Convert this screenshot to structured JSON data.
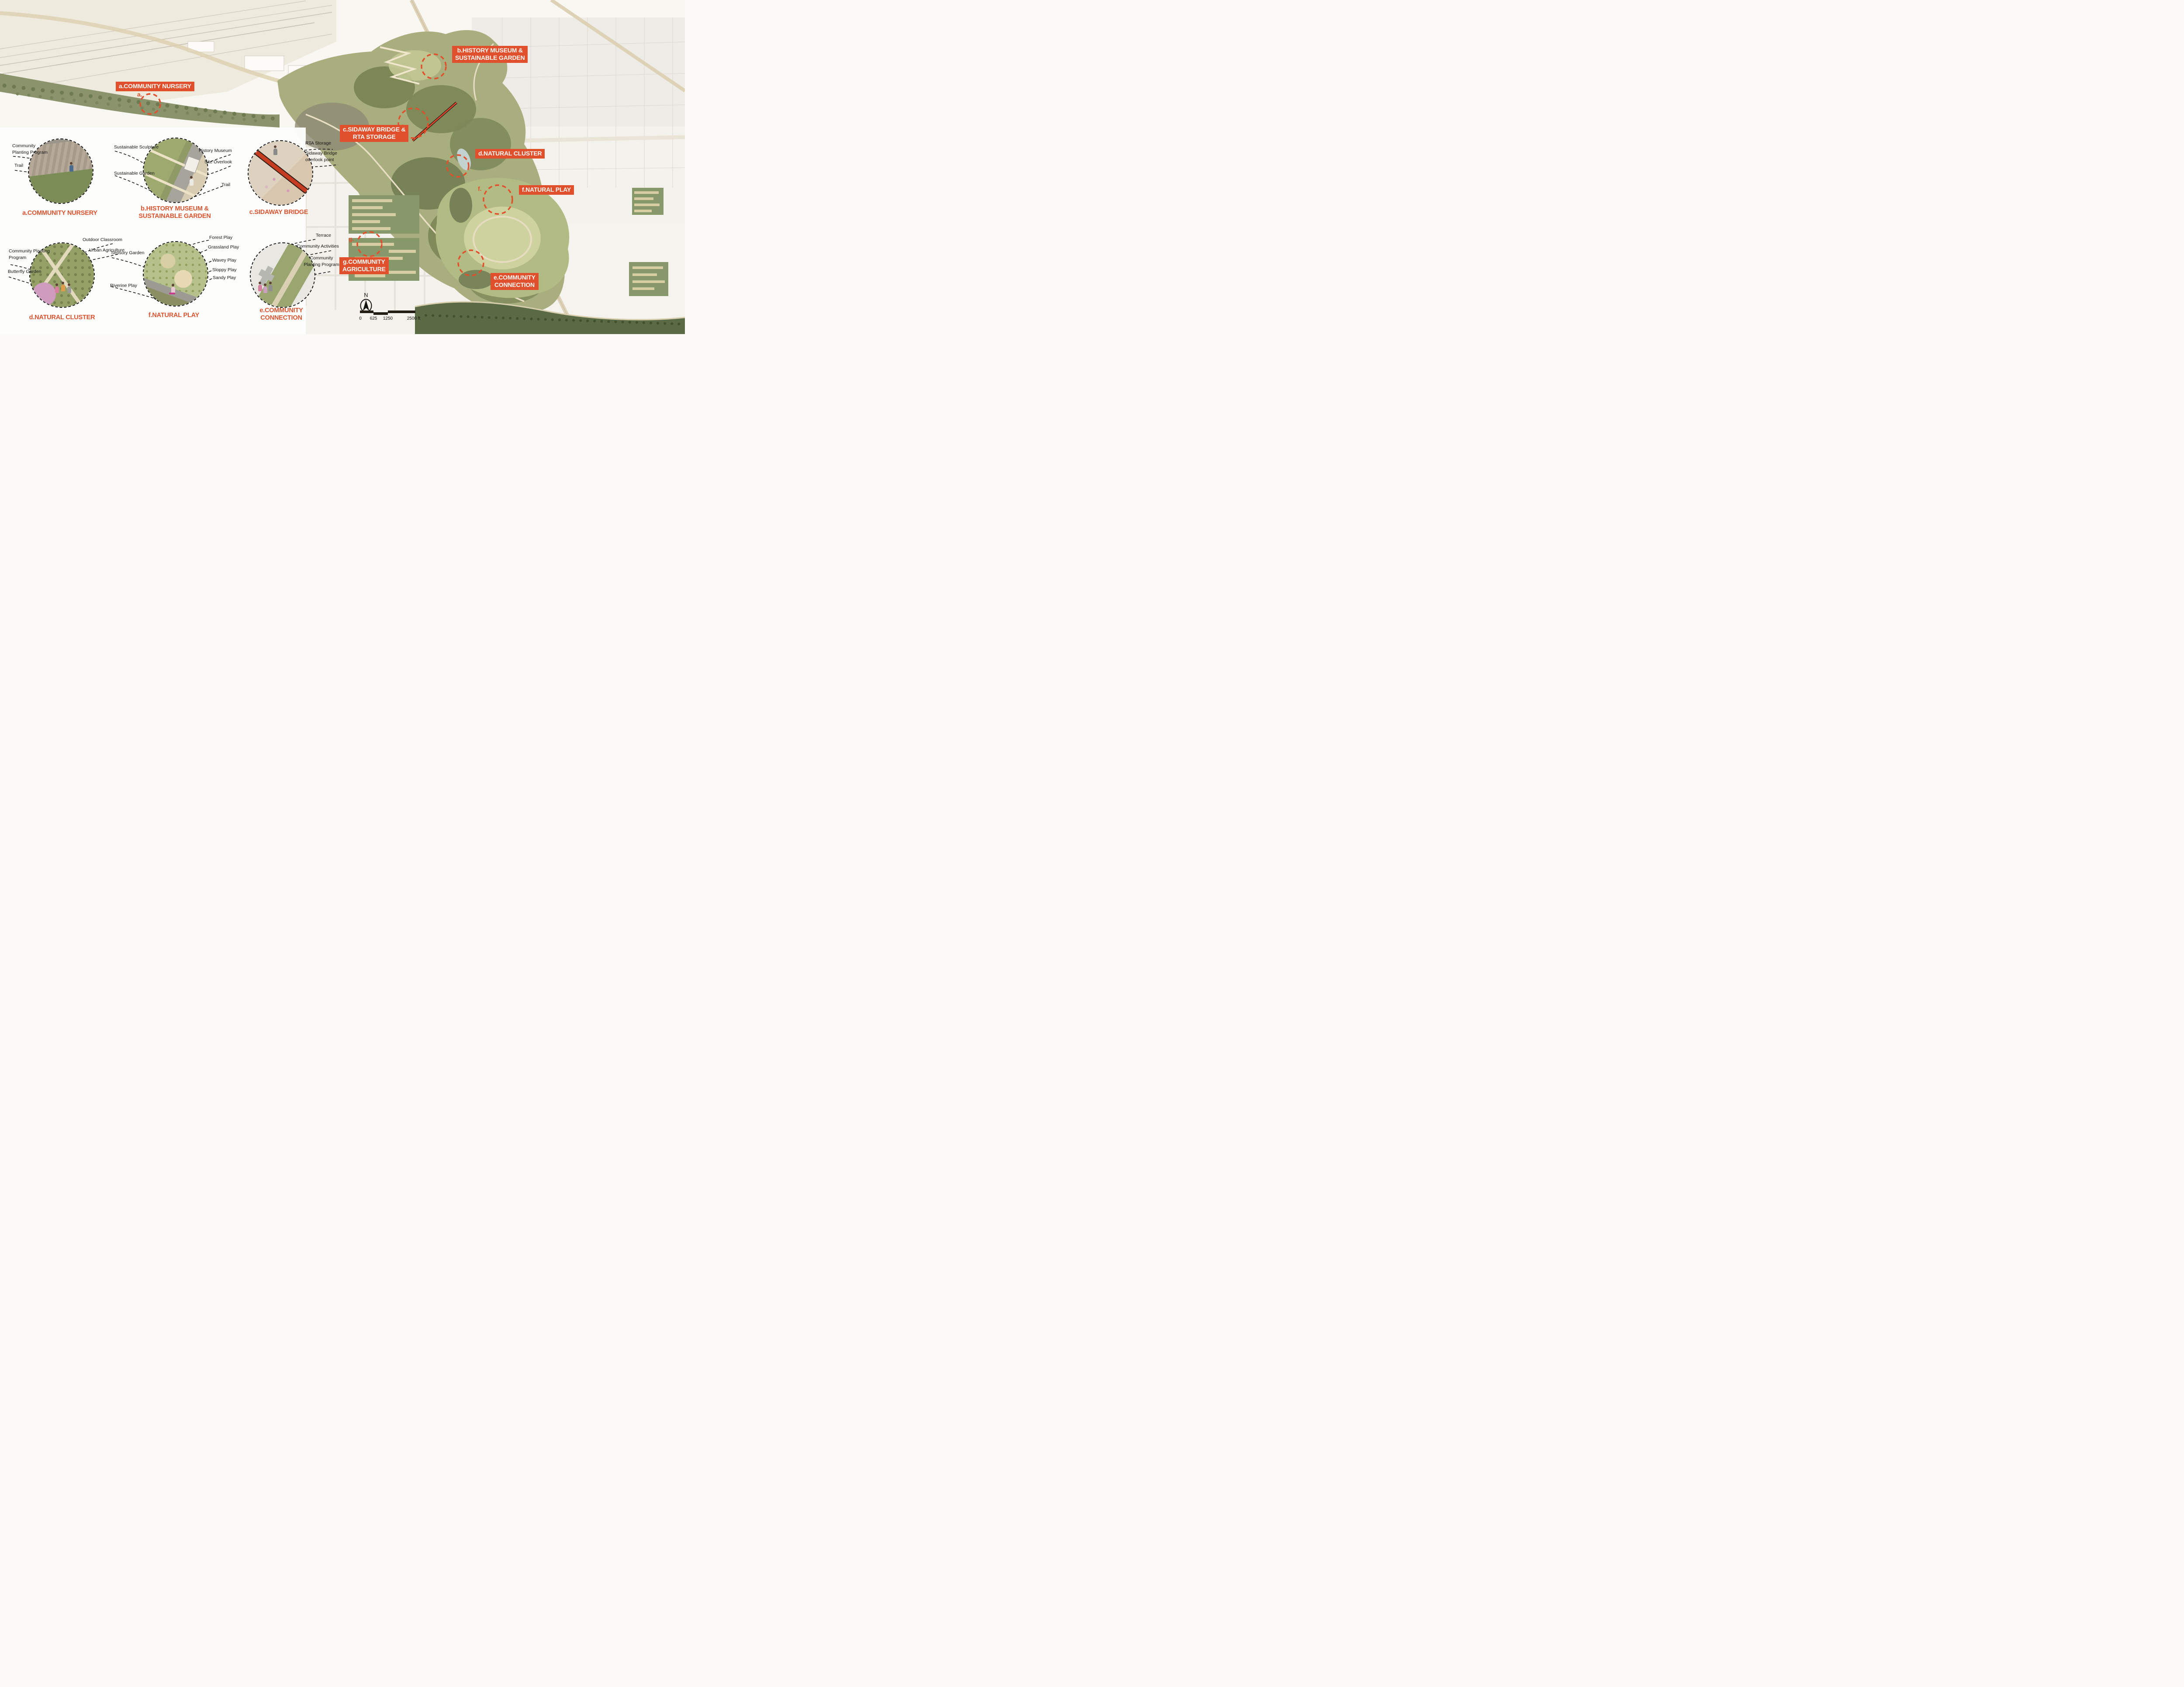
{
  "palette": {
    "accent_red": "#E0502C",
    "caption_red": "#D8532F",
    "ink": "#151515"
  },
  "map_overlays": {
    "a": {
      "line1": "a.COMMUNITY NURSERY",
      "line2": ""
    },
    "b": {
      "line1": "b.HISTORY MUSEUM &",
      "line2": "SUSTAINABLE GARDEN"
    },
    "c": {
      "line1": "c.SIDAWAY BRIDGE &",
      "line2": "RTA STORAGE"
    },
    "d": {
      "line1": "d.NATURAL CLUSTER",
      "line2": ""
    },
    "f": {
      "line1": "f.NATURAL PLAY",
      "line2": ""
    },
    "g": {
      "line1": "g.COMMUNITY",
      "line2": "AGRICULTURE"
    },
    "e": {
      "line1": "e.COMMUNITY",
      "line2": "CONNECTION"
    }
  },
  "map_markers": {
    "a": "a.",
    "c": "c.",
    "f": "f.",
    "g": "g."
  },
  "details": {
    "a": {
      "caption": "a.COMMUNITY NURSERY",
      "labels": {
        "planting": "Community Planting Program",
        "trail": "Trail"
      }
    },
    "b": {
      "caption_line1": "b.HISTORY MUSEUM &",
      "caption_line2": "SUSTAINABLE GARDEN",
      "labels": {
        "sculpture": "Sustainable Sculpture",
        "museum": "History Museum",
        "overlook": "Site Overlook",
        "garden": "Sustainable Garden",
        "trail": "Trail"
      }
    },
    "c": {
      "caption": "c.SIDAWAY BRIDGE",
      "labels": {
        "rta": "RTA Storage",
        "overlook": "Sidaway Bridge overlook point"
      }
    },
    "d": {
      "caption": "d.NATURAL CLUSTER",
      "labels": {
        "classroom": "Outdoor Classroom",
        "agriculture": "Urban Agriculture",
        "planting": "Community Planting Program",
        "butterfly": "Butterfly Garden"
      }
    },
    "f": {
      "caption": "f.NATURAL PLAY",
      "labels": {
        "forest": "Forest Play",
        "grassland": "Grassland Play",
        "sensory": "Sensory Garden",
        "wavey": "Wavey Play",
        "sloppy": "Sloppy Play",
        "sandy": "Sandy Play",
        "riverine": "Riverine Play"
      }
    },
    "e": {
      "caption_line1": "e.COMMUNITY",
      "caption_line2": "CONNECTION",
      "labels": {
        "terrace": "Terrace",
        "activities": "Community Activities",
        "planting": "Community Planting Program"
      }
    }
  },
  "legend": {
    "north": "N",
    "scale_ticks": [
      "0",
      "625",
      "1250",
      "2500 ft"
    ]
  }
}
